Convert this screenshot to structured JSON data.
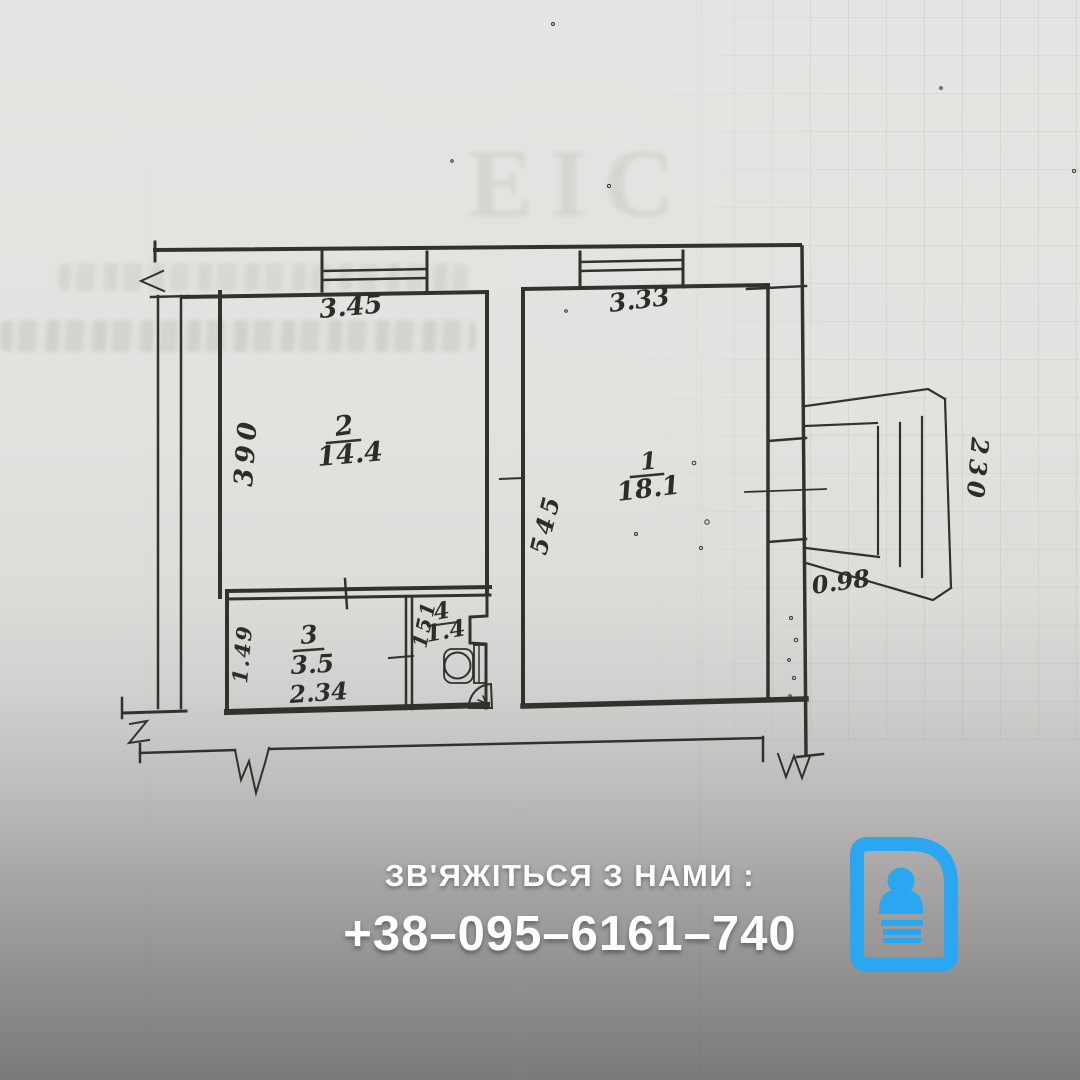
{
  "plan": {
    "watermark": "ЕІС",
    "rooms": [
      {
        "id": "room-1",
        "number": "1",
        "area": "18.1"
      },
      {
        "id": "room-2",
        "number": "2",
        "area": "14.4"
      },
      {
        "id": "room-3",
        "number": "3",
        "area": "3.5"
      },
      {
        "id": "room-4",
        "number": "4",
        "area": "1.4"
      }
    ],
    "dimensions": {
      "room2_top": "3.45",
      "room2_left": "390",
      "room1_top": "3.33",
      "room1_left": "545",
      "room3_left": "1.49",
      "room3_bottom": "2.34",
      "room4_left": "151",
      "balcony_side": "230",
      "balcony_bottom": "0.98"
    }
  },
  "contact": {
    "label": "ЗВ'ЯЖІТЬСЯ З НАМИ :",
    "phone": "+38–095–6161–740"
  },
  "icon": {
    "name": "contact-card-icon"
  },
  "colors": {
    "ink": "#33312c",
    "paper": "#e6e4e2",
    "overlay_gray": "#7b7a78",
    "accent": "#2aa7f0"
  }
}
